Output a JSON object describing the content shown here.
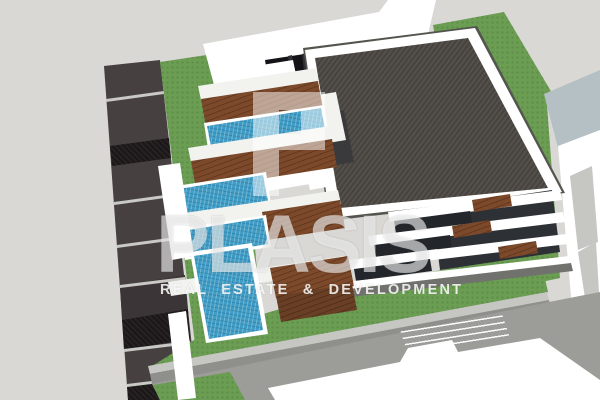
{
  "scene": {
    "title": "3D architectural exterior rendering",
    "style": "SketchUp-style aerial axonometric view",
    "subject": "Modern terraced apartment building with dark gravel flat roof, cascading wooden balcony decks and blue plunge pools, lawn site, side driveway and neighboring white buildings",
    "background_color": "#d9d8d4"
  },
  "watermark": {
    "brand": "PLASIS",
    "tagline": "REAL ESTATE & DEVELOPMENT",
    "logo_icon": "blocky-letter-P",
    "text_color": "#ffffff"
  },
  "palette": {
    "bg": "#d9d8d4",
    "lawn_green": "#6b9e53",
    "roof_dark": "#46423f",
    "roof_dark_hi": "#56504b",
    "street_dark": "#474041",
    "street_darker": "#3c3537",
    "street_black": "#1b1718",
    "street_line": "#c9c9c5",
    "pool_blue": "#3f9dc6",
    "deck_brown": "#7c4a2b",
    "deck_brown_dk": "#63381f",
    "white_wall": "#ffffff",
    "white_soft": "#f2f2ef",
    "gray_shade": "#c6c6c2",
    "concrete": "#9c9c99",
    "wall_face": "#8f8f8c",
    "charcoal": "#2d3136",
    "recess_dark": "#23262b",
    "glass_black": "#141418",
    "mullion": "#303036",
    "courtyard": "#3a3a3d",
    "neighbor_roof": "#b5c0c4",
    "platform_side": "#a2b2b7",
    "base_shadow": "#71716d",
    "edge_line": "#55554f"
  },
  "elements": [
    {
      "name": "street-strip",
      "label": "dark paved driveway with lane segments, left side"
    },
    {
      "name": "site-lawn",
      "label": "green lawn surrounding the building"
    },
    {
      "name": "neighbor-building-top",
      "label": "white flat-roof neighboring building, top"
    },
    {
      "name": "roof-garden-platform",
      "label": "raised green roof platform, upper right"
    },
    {
      "name": "neighbor-building-right",
      "label": "white neighboring building with blue-gray roof, right"
    },
    {
      "name": "main-roof",
      "label": "dark gravel textured flat roof with white parapet"
    },
    {
      "name": "penthouse-volumes",
      "label": "white rooftop penthouse boxes and dark courtyard"
    },
    {
      "name": "terraces",
      "label": "stepped terraces with wooden decks and blue pools"
    },
    {
      "name": "facade-bands",
      "label": "white floor slabs with dark glazing and wood panels"
    },
    {
      "name": "retaining-wall",
      "label": "light gray retaining wall across lower lawn"
    },
    {
      "name": "neighbor-building-bottom",
      "label": "white building roof with stair hatching, bottom"
    },
    {
      "name": "watermark",
      "label": "PLASIS real estate watermark with blocky P logo"
    }
  ]
}
